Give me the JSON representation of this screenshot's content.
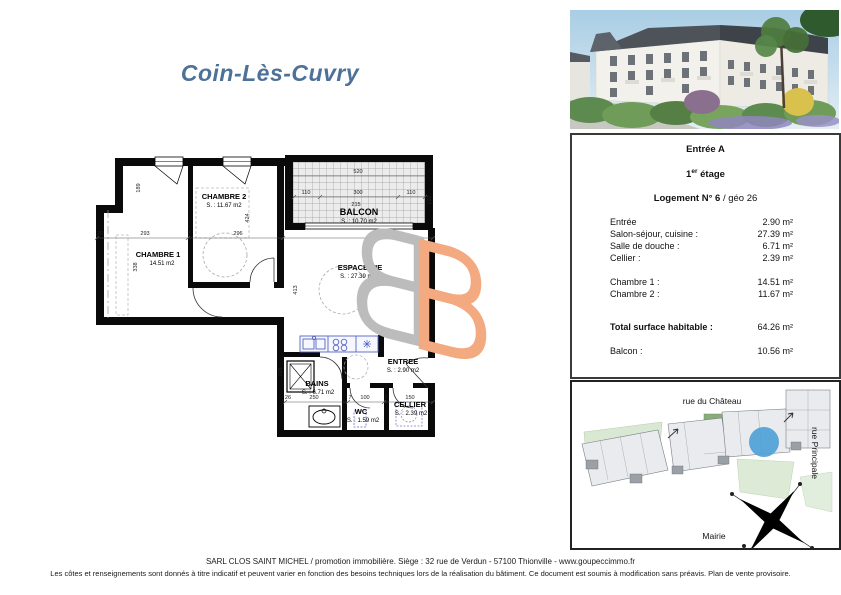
{
  "title": "Coin-Lès-Cuvry",
  "plan": {
    "rooms": {
      "chambre2": {
        "name": "CHAMBRE 2",
        "area": "S. :   11.67 m2"
      },
      "chambre1": {
        "name": "CHAMBRE 1",
        "area": "14.51 m2"
      },
      "balcon": {
        "name": "BALCON",
        "area": "S. :  10.70 m2"
      },
      "espace_vie": {
        "name": "ESPACE VIE",
        "area": "S. : 27.39 m2"
      },
      "entree": {
        "name": "ENTREE",
        "area": "S. : 2.90 m2"
      },
      "bains": {
        "name": "BAINS",
        "area": "S. : 6.71 m2"
      },
      "wc": {
        "name": "WC",
        "area": "S. : 1.59 m2"
      },
      "cellier": {
        "name": "CELLIER",
        "area": "S. : 2.39 m2"
      }
    },
    "dims": {
      "d520": "520",
      "d110": "110",
      "d300": "300",
      "d215": "215",
      "d192": "192",
      "d20": "20",
      "d293": "293",
      "d296": "296",
      "d7": "7",
      "d68": "68",
      "d189": "189",
      "d424": "424",
      "d338": "338",
      "d413": "413",
      "d226": "226",
      "d26": "26",
      "d250": "250",
      "d100": "100",
      "d150": "150",
      "d36": "36"
    }
  },
  "info_panel": {
    "entrance": "Entrée A",
    "floor_num": "1",
    "floor_sup": "er",
    "floor_rest": " étage",
    "unit_bold": "Logement N° 6",
    "unit_rest": " / géo 26",
    "rows": [
      {
        "label": "Entrée",
        "value": "2.90 m²"
      },
      {
        "label": "Salon-séjour, cuisine :",
        "value": "27.39 m²"
      },
      {
        "label": "Salle de douche :",
        "value": "6.71 m²"
      },
      {
        "label": "Cellier :",
        "value": "2.39 m²"
      }
    ],
    "rows2": [
      {
        "label": "Chambre 1 :",
        "value": "14.51 m²"
      },
      {
        "label": "Chambre 2 :",
        "value": "11.67 m²"
      }
    ],
    "total_label": "Total surface habitable :",
    "total_value": "64.26 m²",
    "balcony_label": "Balcon :",
    "balcony_value": "10.56 m²"
  },
  "site_map": {
    "street_top": "rue du Château",
    "street_right": "rue Principale",
    "landmark": "Mairie"
  },
  "footer": {
    "line1": "SARL CLOS SAINT MICHEL / promotion immobilière. Siège : 32 rue de Verdun - 57100 Thionville - www.goupeccimmo.fr",
    "line2": "Les côtes et renseignements sont donnés à titre indicatif et peuvent varier en fonction des besoins techniques lors de la réalisation du bâtiment. Ce document est soumis à modification sans préavis. Plan de vente provisoire."
  },
  "colors": {
    "accent_blue": "#4d7198",
    "watermark_gray": "#bcbcbc",
    "watermark_orange": "#f3aa80",
    "marker_blue": "#4da0d6"
  }
}
